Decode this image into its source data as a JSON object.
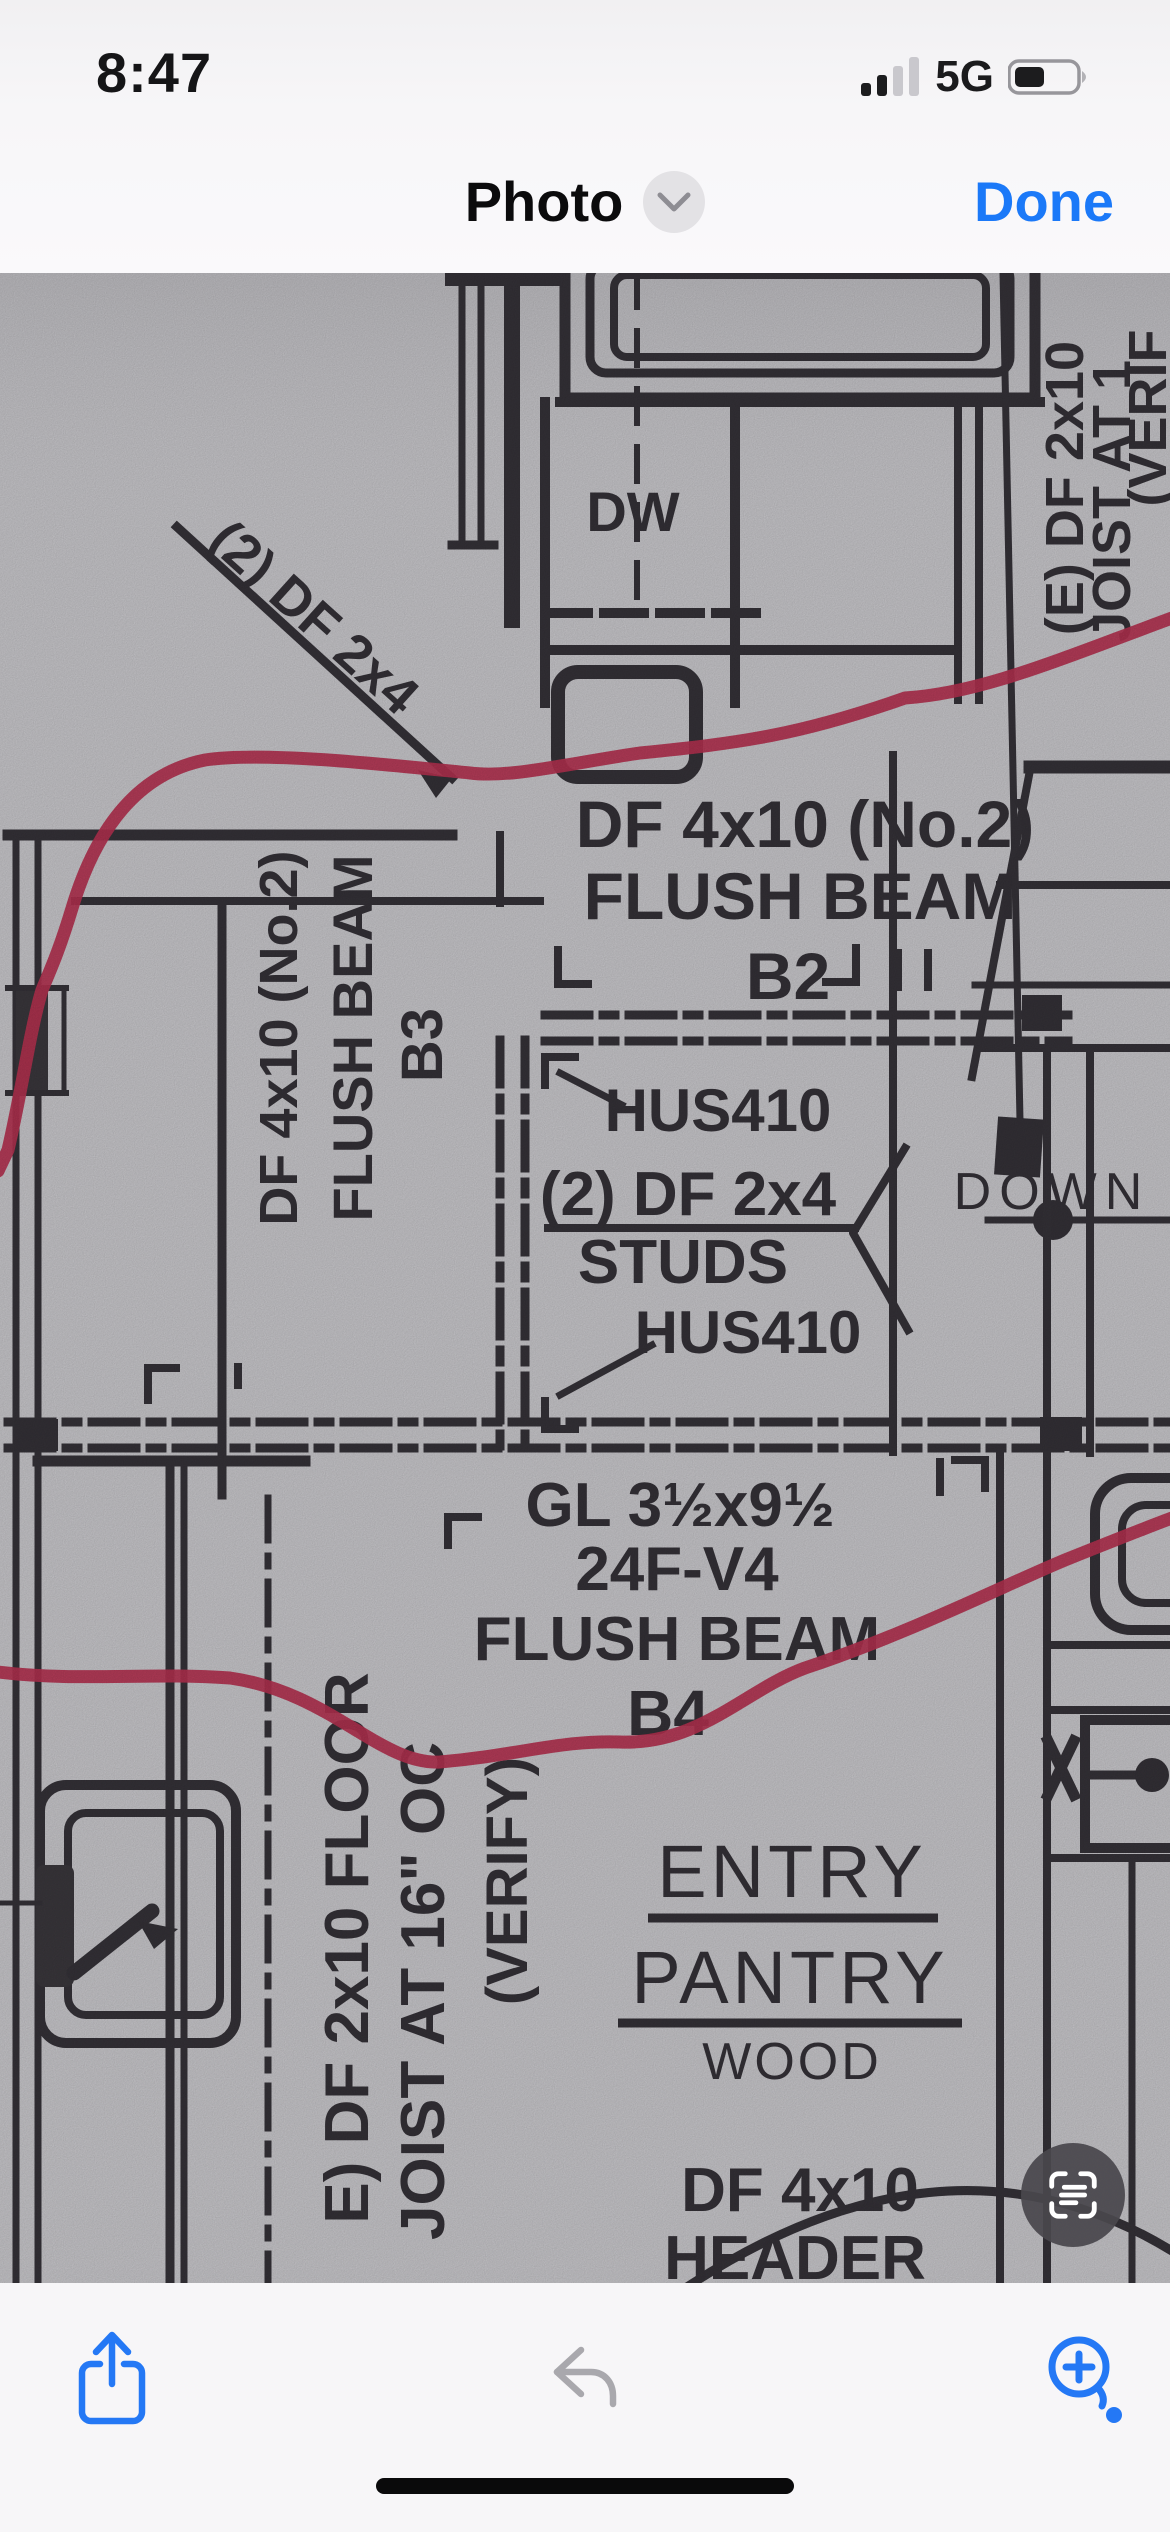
{
  "status_bar": {
    "time": "8:47",
    "network": "5G"
  },
  "nav_bar": {
    "title": "Photo",
    "done_label": "Done"
  },
  "photo": {
    "plan": {
      "dw_label": "DW",
      "diag_note": "(2) DF 2x4",
      "beam_b2": {
        "line1": "DF 4x10 (No.2)",
        "line2": "FLUSH BEAM",
        "line3": "B2"
      },
      "beam_b3": {
        "line1": "DF 4x10 (No.2)",
        "line2": "FLUSH BEAM",
        "line3": "B3"
      },
      "hanger_top": "HUS410",
      "studs_line1": "(2) DF 2x4",
      "studs_line2": "STUDS",
      "hanger_bottom": "HUS410",
      "down_label": "DOWN",
      "beam_b4": {
        "line1": "GL 3½x9½",
        "line2": "24F-V4",
        "line3": "FLUSH BEAM",
        "line4": "B4"
      },
      "room": {
        "line1": "ENTRY",
        "line2": "PANTRY",
        "line3": "WOOD"
      },
      "joist_left": {
        "line1": "E) DF 2x10 FLOOR",
        "line2": "JOIST AT 16\" OC",
        "line3": "(VERIFY)"
      },
      "joist_right": {
        "line1": "(E) DF 2x10",
        "line2": "JOIST AT 1",
        "line3": "(VERIF"
      },
      "header_note": {
        "line1": "DF 4x10",
        "line2": "HEADER"
      }
    },
    "annotation_color": "#b53150",
    "ink_color": "#343137",
    "paper_color": "#c7c6ca"
  },
  "toolbar": {
    "share_icon": "share-up-arrow",
    "undo_icon": "undo-arrow",
    "markup_zoom_icon": "loupe-plus",
    "live_text_icon": "live-text"
  },
  "colors": {
    "ios_blue": "#1b79f8",
    "toolbar_bg": "#f7f6f8",
    "disabled_gray": "#a9a8ad"
  }
}
